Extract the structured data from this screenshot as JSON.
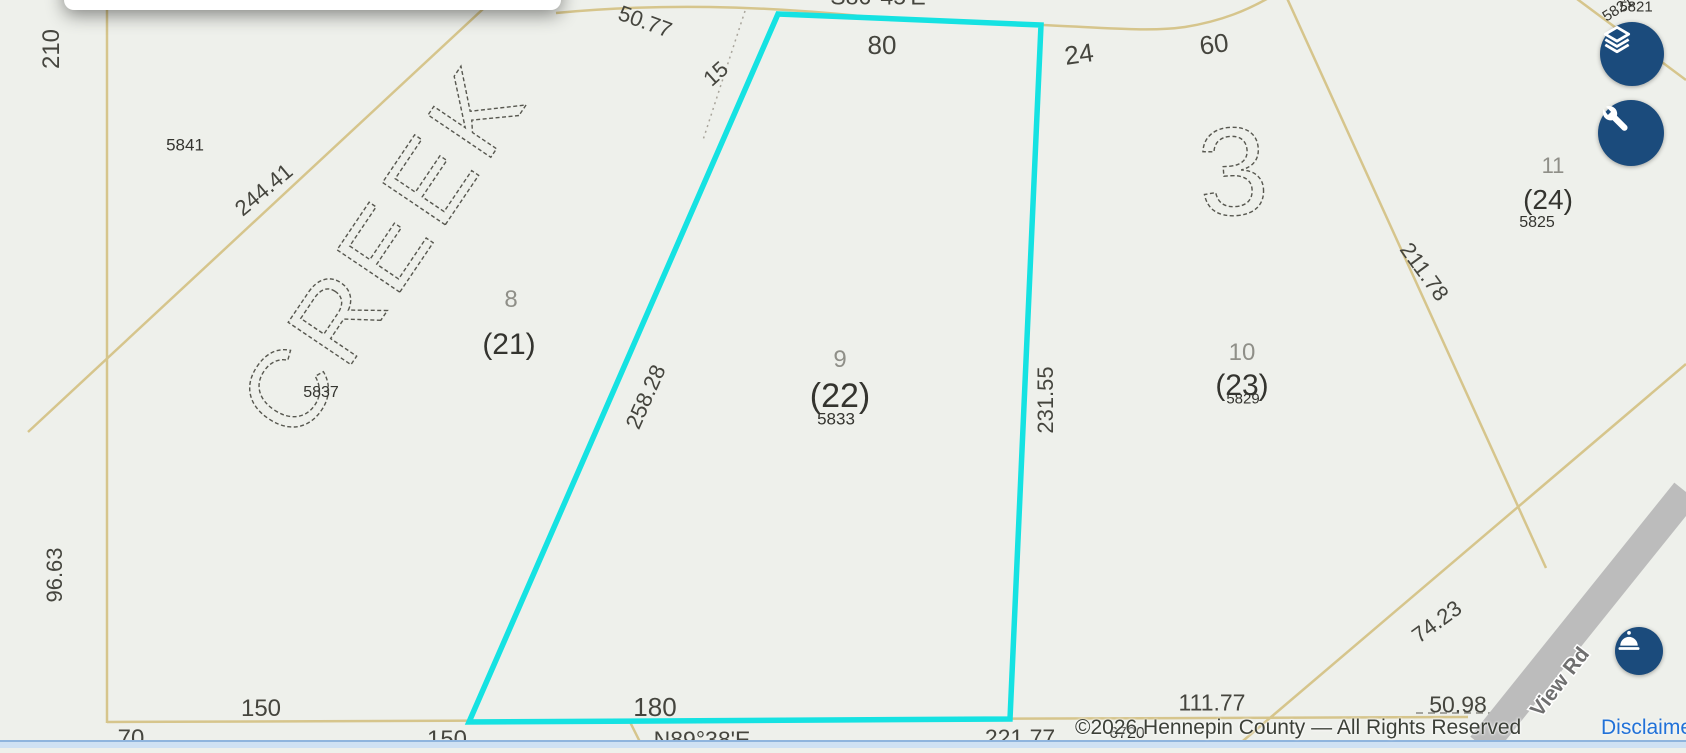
{
  "map": {
    "attribution": {
      "copyright": "©2026 Hennepin County — All Rights Reserved",
      "disclaimer": "Disclaimer"
    },
    "labels": {
      "bearing_top": "S86°45'E",
      "bearing_bottom": "N89°38'E",
      "dim_210": "210",
      "dim_50_77": "50.77",
      "dim_15": "15",
      "dim_80": "80",
      "dim_24": "24",
      "dim_60": "60",
      "dim_244_41": "244.41",
      "dim_258_28": "258.28",
      "dim_231_55": "231.55",
      "dim_211_78": "211.78",
      "dim_96_63": "96.63",
      "dim_150_left": "150",
      "dim_70": "70",
      "dim_180": "180",
      "dim_150_bottom": "150",
      "dim_221_77": "221.77",
      "dim_111_77": "111.77",
      "dim_50_98": "50.98",
      "dim_74_23": "74.23",
      "lot_8": "8",
      "lot_9": "9",
      "lot_10": "10",
      "lot_11": "11",
      "parcel_21": "(21)",
      "parcel_22": "(22)",
      "parcel_23": "(23)",
      "parcel_24": "(24)",
      "house_5841": "5841",
      "house_5837": "5837",
      "house_5833": "5833",
      "house_5829": "5829",
      "house_5825": "5825",
      "house_5821": "5821",
      "house_6720": "6720",
      "block_3": "3",
      "subdivision": "CREEK",
      "road_name": "View Rd"
    },
    "colors": {
      "highlight": "#15e2e2",
      "parcel_line": "#d6c58c",
      "road_fill": "#bcbcbc",
      "button": "#1b4b7c",
      "link": "#2272d8"
    }
  }
}
